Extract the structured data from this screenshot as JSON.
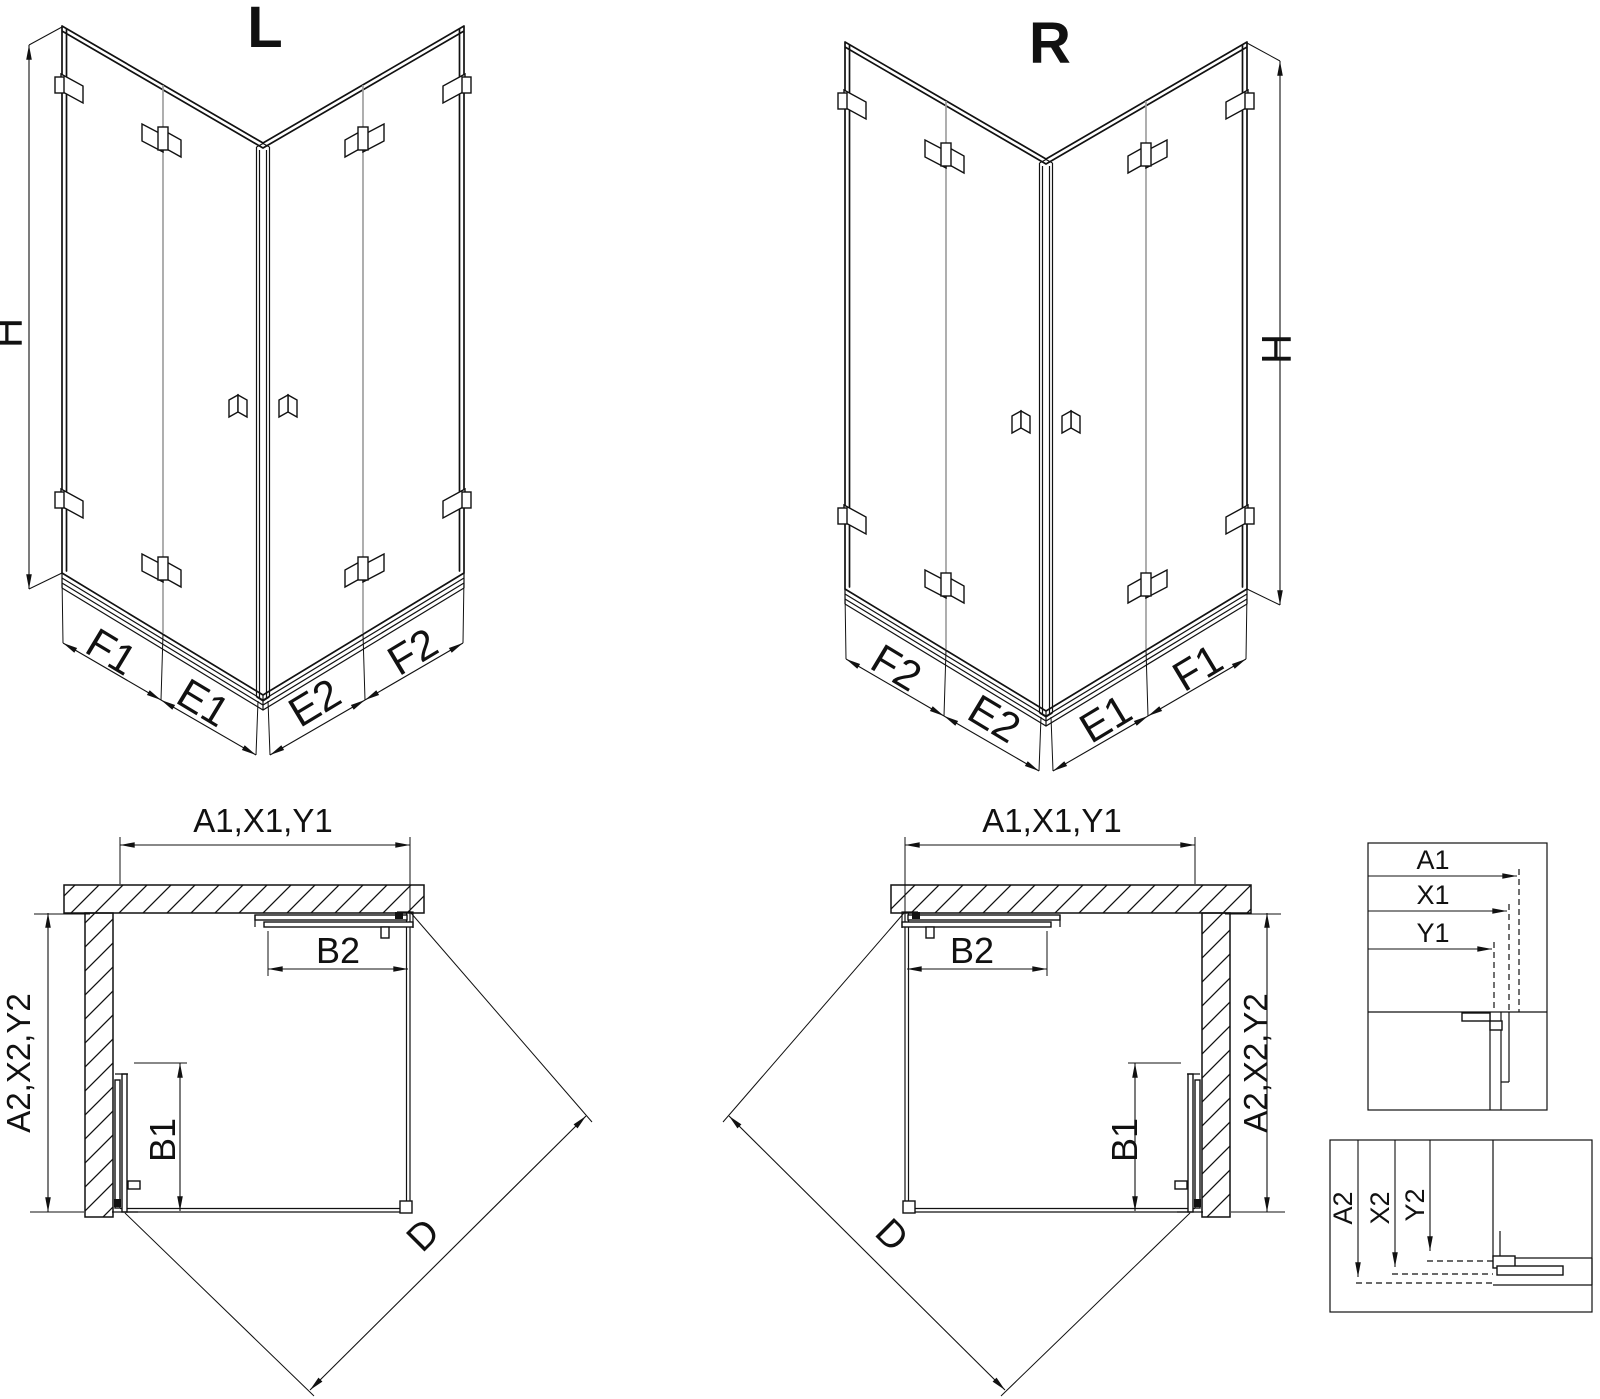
{
  "drawing": {
    "iso_left": {
      "title": "L",
      "height_label": "H",
      "bottom_labels_left": [
        "F1",
        "E1"
      ],
      "bottom_labels_right": [
        "E2",
        "F2"
      ]
    },
    "iso_right": {
      "title": "R",
      "height_label": "H",
      "bottom_labels_left": [
        "F2",
        "E2"
      ],
      "bottom_labels_right": [
        "E1",
        "F1"
      ]
    },
    "plan_left": {
      "width_label": "A1,X1,Y1",
      "depth_label": "A2,X2,Y2",
      "door_top_label": "B2",
      "door_side_label": "B1",
      "diagonal_label": "D"
    },
    "plan_right": {
      "width_label": "A1,X1,Y1",
      "depth_label": "A2,X2,Y2",
      "door_top_label": "B2",
      "door_side_label": "B1",
      "diagonal_label": "D"
    },
    "detail_width": {
      "labels": [
        "A1",
        "X1",
        "Y1"
      ]
    },
    "detail_depth": {
      "labels": [
        "A2",
        "X2",
        "Y2"
      ]
    }
  },
  "colors": {
    "line": "#111111",
    "joint_gray": "#9b9b9b",
    "background": "#ffffff"
  }
}
